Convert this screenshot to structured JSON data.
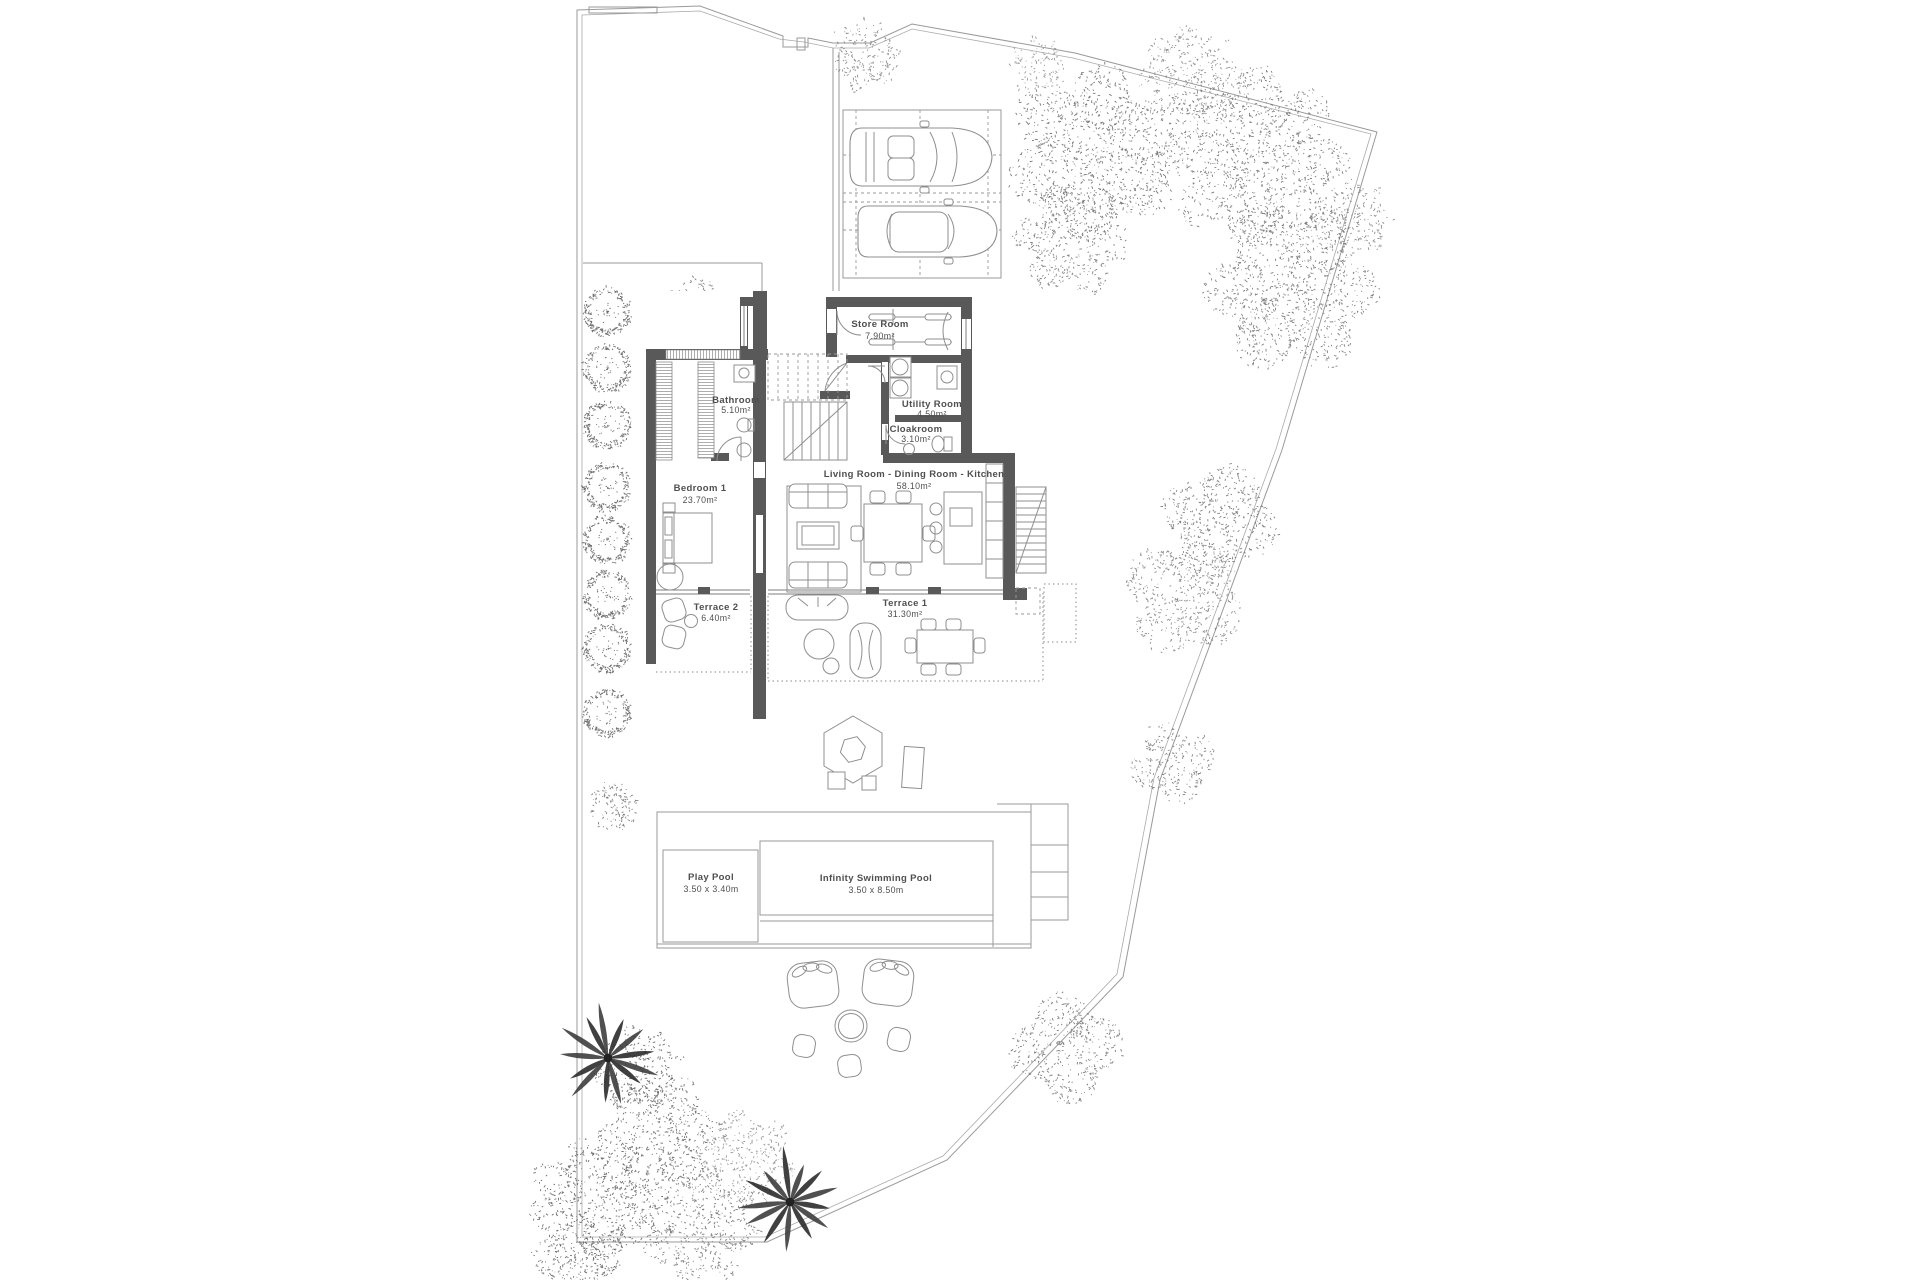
{
  "plan": {
    "rooms": {
      "store": {
        "name": "Store Room",
        "area": "7.90m²"
      },
      "bathroom": {
        "name": "Bathroom",
        "area": "5.10m²"
      },
      "utility": {
        "name": "Utility Room",
        "area": "4.50m²"
      },
      "cloakroom": {
        "name": "Cloakroom",
        "area": "3.10m²"
      },
      "living": {
        "name": "Living Room - Dining Room - Kitchen",
        "area": "58.10m²"
      },
      "bedroom1": {
        "name": "Bedroom 1",
        "area": "23.70m²"
      },
      "terrace2": {
        "name": "Terrace 2",
        "area": "6.40m²"
      },
      "terrace1": {
        "name": "Terrace 1",
        "area": "31.30m²"
      }
    },
    "pools": {
      "play": {
        "name": "Play Pool",
        "size": "3.50 x 3.40m"
      },
      "infinity": {
        "name": "Infinity Swimming Pool",
        "size": "3.50 x 8.50m"
      }
    },
    "colors": {
      "wall": "#595959",
      "line": "#9a9a9a",
      "text": "#4f4f4f"
    }
  }
}
